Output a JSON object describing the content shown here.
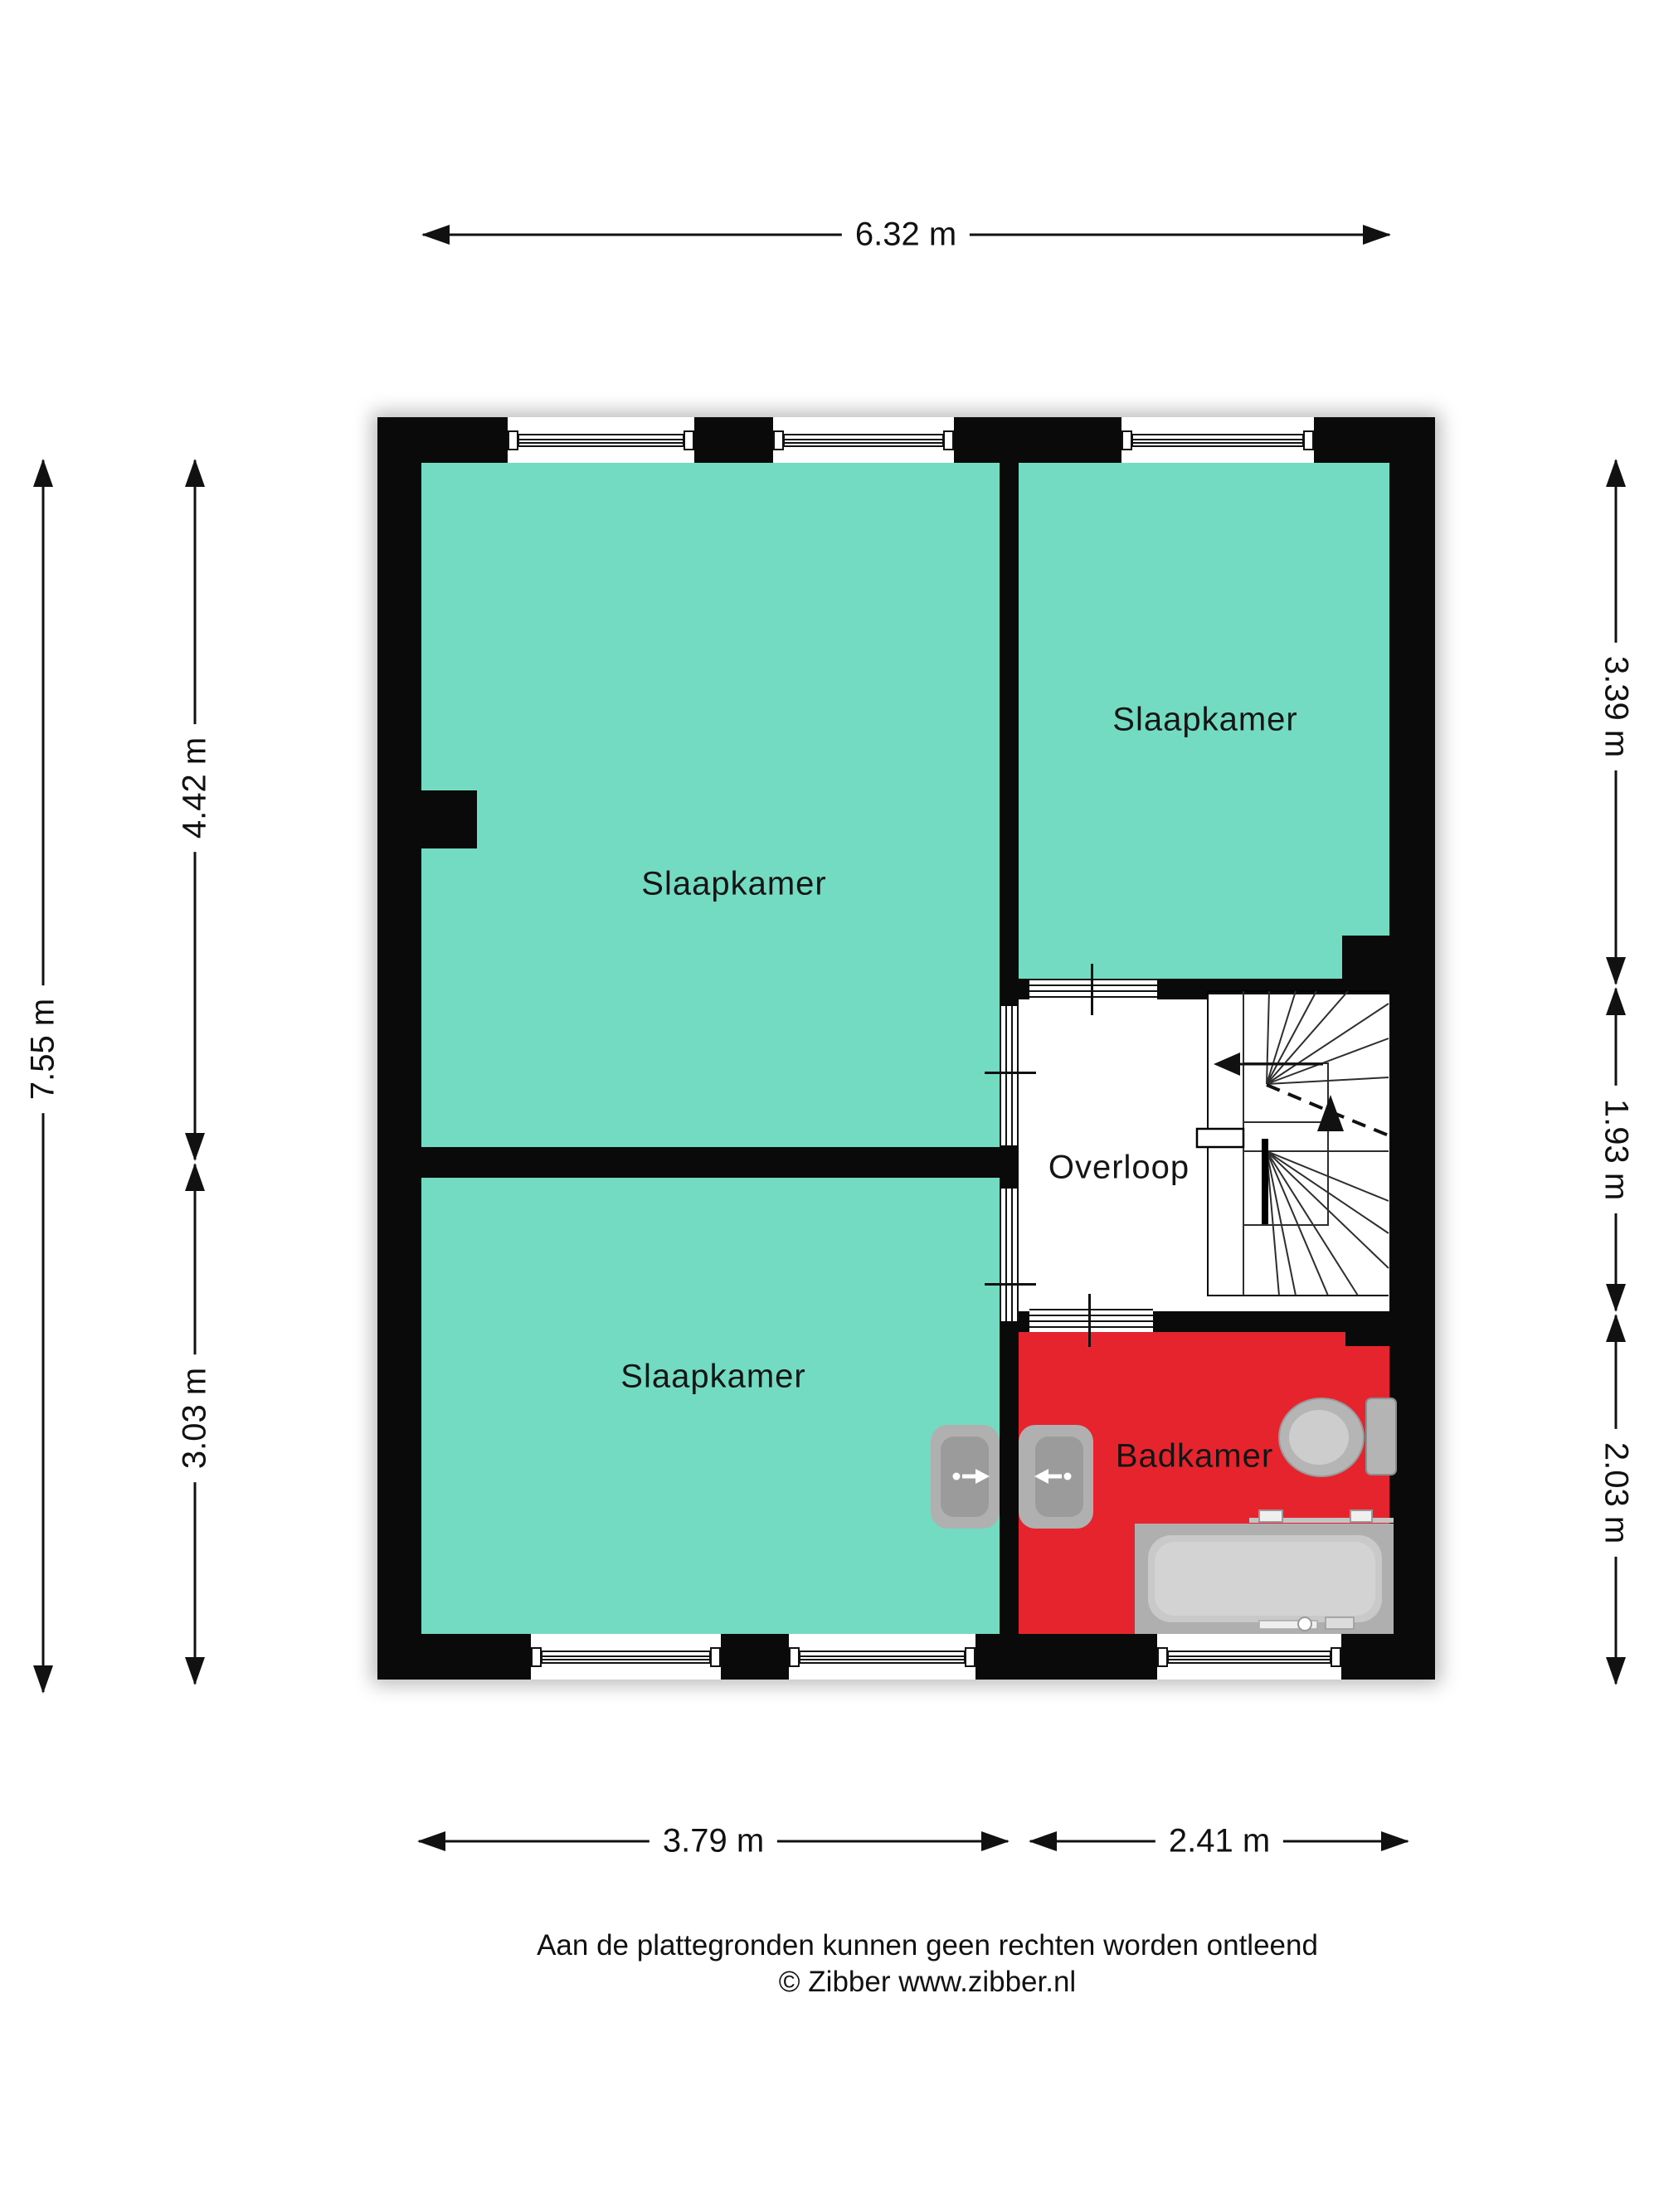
{
  "type": "floorplan",
  "rooms": {
    "bedroom_large": "Slaapkamer",
    "bedroom_top_right": "Slaapkamer",
    "bedroom_bottom_left": "Slaapkamer",
    "landing": "Overloop",
    "bathroom": "Badkamer"
  },
  "dimensions": {
    "top": "6.32 m",
    "left_total": "7.55 m",
    "left_upper": "4.42 m",
    "left_lower": "3.03 m",
    "right_upper": "3.39 m",
    "right_middle": "1.93 m",
    "right_lower": "2.03 m",
    "bottom_left": "3.79 m",
    "bottom_right": "2.41 m"
  },
  "footer": {
    "line1": "Aan de plattegronden kunnen geen rechten worden ontleend",
    "line2": "© Zibber www.zibber.nl"
  },
  "colors": {
    "wall": "#0a0a0a",
    "bedroom_fill": "#72dbc1",
    "bathroom_fill": "#e6242e",
    "landing_fill": "#ffffff",
    "fixture_gray": "#b0b0b0",
    "fixture_gray_light": "#c9c9c9"
  },
  "fixtures": [
    "double-sink",
    "toilet",
    "bathtub",
    "winder-staircase"
  ]
}
